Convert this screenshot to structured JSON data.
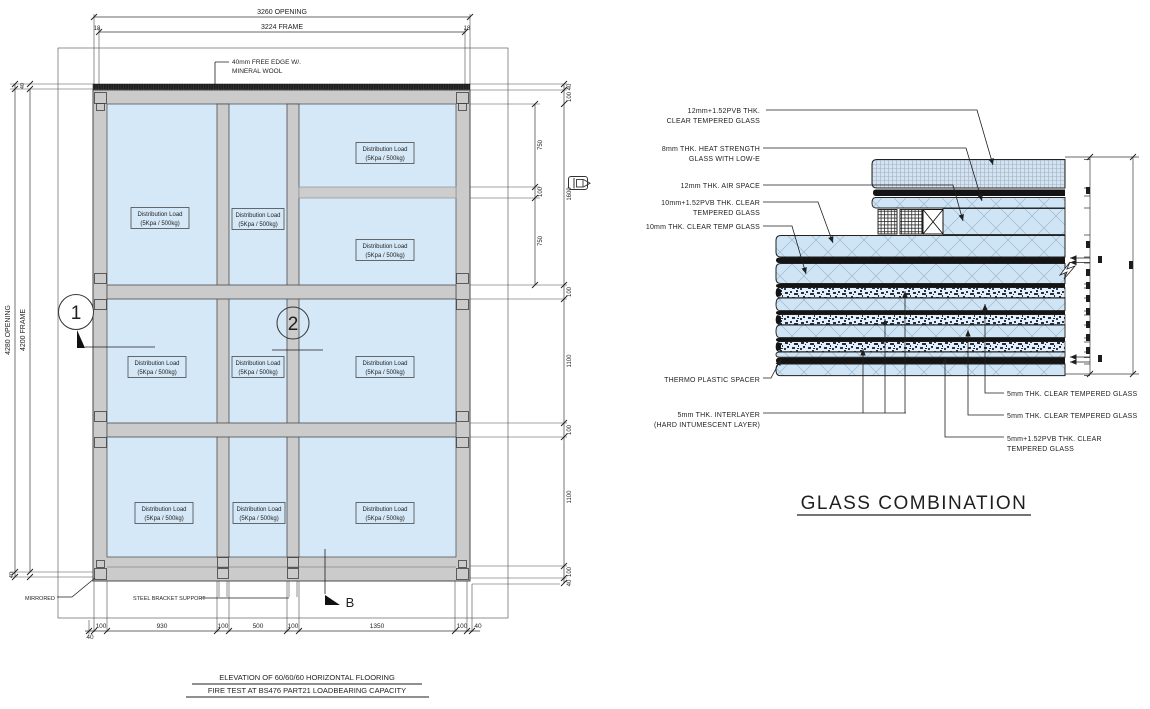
{
  "colors": {
    "glass_blue": "#d5e8f7",
    "detail_glass_blue": "#cfe5f5",
    "frame_gray": "#cbcbcb",
    "black_band": "#141414",
    "line_dark": "#2b2b2b"
  },
  "elevation": {
    "dims_top": {
      "opening": "3260 OPENING",
      "frame": "3224 FRAME",
      "gap_left": "18",
      "gap_right": "18"
    },
    "dims_left": {
      "opening": "4280 OPENING",
      "frame": "4200 FRAME",
      "gap_top": "40",
      "gap_bottom": "40"
    },
    "dims_right_inner": [
      "750",
      "100",
      "750"
    ],
    "dims_right_outer": [
      "40",
      "100",
      "1600",
      "100",
      "1100",
      "100",
      "1100",
      "100",
      "40"
    ],
    "dims_bottom": [
      "40",
      "100",
      "930",
      "100",
      "500",
      "100",
      "1350",
      "100",
      "40"
    ],
    "panel_label": {
      "line1": "Distribution Load",
      "line2": "(5Kpa / 500kg)"
    },
    "notes": {
      "free_edge_line1": "40mm FREE EDGE W/.",
      "free_edge_line2": "MINERAL WOOL",
      "steel_bracket": "STEEL BRACKET SUPPORT",
      "mirrored": "MIRRORED"
    },
    "markers": {
      "detail_1": "1",
      "detail_2": "2",
      "section_b": "B"
    }
  },
  "glass_combination": {
    "title": "GLASS COMBINATION",
    "labels_left": {
      "l1a": "12mm+1.52PVB THK.",
      "l1b": "CLEAR TEMPERED GLASS",
      "l2a": "8mm THK. HEAT STRENGTH",
      "l2b": "GLASS WITH LOW-E",
      "l3": "12mm THK. AIR SPACE",
      "l4a": "10mm+1.52PVB THK. CLEAR",
      "l4b": "TEMPERED GLASS",
      "l5": "10mm THK. CLEAR TEMP GLASS",
      "l6": "THERMO PLASTIC SPACER",
      "l7a": "5mm THK. INTERLAYER",
      "l7b": "(HARD INTUMESCENT LAYER)"
    },
    "labels_right": {
      "r1": "5mm THK. CLEAR TEMPERED GLASS",
      "r2": "5mm THK. CLEAR TEMPERED GLASS",
      "r3a": "5mm+1.52PVB THK. CLEAR",
      "r3b": "TEMPERED GLASS"
    }
  },
  "footer": {
    "title_line1": "ELEVATION OF 60/60/60 HORIZONTAL FLOORING",
    "title_line2": "FIRE TEST AT BS476 PART21 LOADBEARING CAPACITY"
  }
}
